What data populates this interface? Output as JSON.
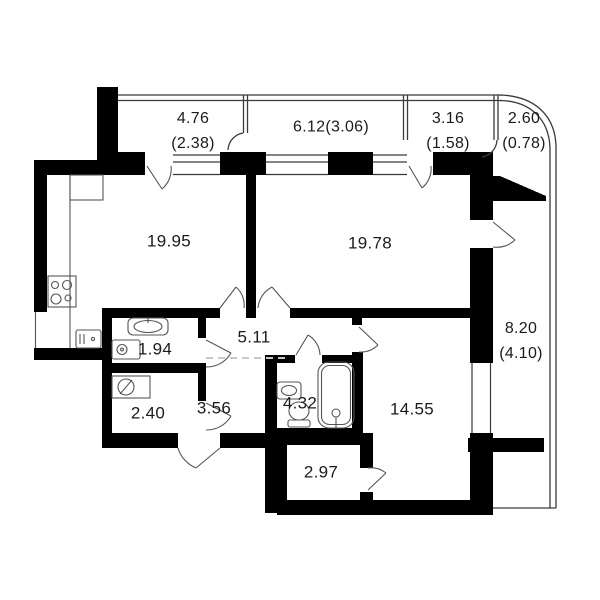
{
  "plan": {
    "type": "apartment-floor-plan",
    "colors": {
      "wall": "#000000",
      "thin_line": "#3a3a3a",
      "fixture_line": "#555555",
      "dashed_line": "#c8c8c8",
      "text": "#1b1b1b",
      "background": "#ffffff"
    },
    "rooms": [
      {
        "id": "kitchen-living",
        "area": "19.95"
      },
      {
        "id": "bedroom-1",
        "area": "19.78"
      },
      {
        "id": "corridor",
        "area": "5.11"
      },
      {
        "id": "bathroom-small",
        "area": "1.94"
      },
      {
        "id": "wc",
        "area": "2.40"
      },
      {
        "id": "hall",
        "area": "3.56"
      },
      {
        "id": "bathroom",
        "area": "4.32"
      },
      {
        "id": "bedroom-2",
        "area": "14.55"
      },
      {
        "id": "wardrobe",
        "area": "2.97"
      }
    ],
    "balconies": [
      {
        "id": "balcony-top-left",
        "area": "4.76",
        "area_reduced": "(2.38)"
      },
      {
        "id": "balcony-top-center",
        "area": "6.12",
        "area_reduced": "(3.06)"
      },
      {
        "id": "balcony-top-right",
        "area": "3.16",
        "area_reduced": "(1.58)"
      },
      {
        "id": "balcony-corner",
        "area": "2.60",
        "area_reduced": "(0.78)"
      },
      {
        "id": "balcony-right",
        "area": "8.20",
        "area_reduced": "(4.10)"
      }
    ],
    "icons": [
      "stove-icon",
      "kitchen-sink-icon",
      "kitchen-cabinet-icon",
      "sink-icon",
      "washing-machine-icon",
      "water-heater-icon",
      "toilet-icon",
      "bathtub-icon",
      "door-swing-icon",
      "window-icon"
    ]
  }
}
